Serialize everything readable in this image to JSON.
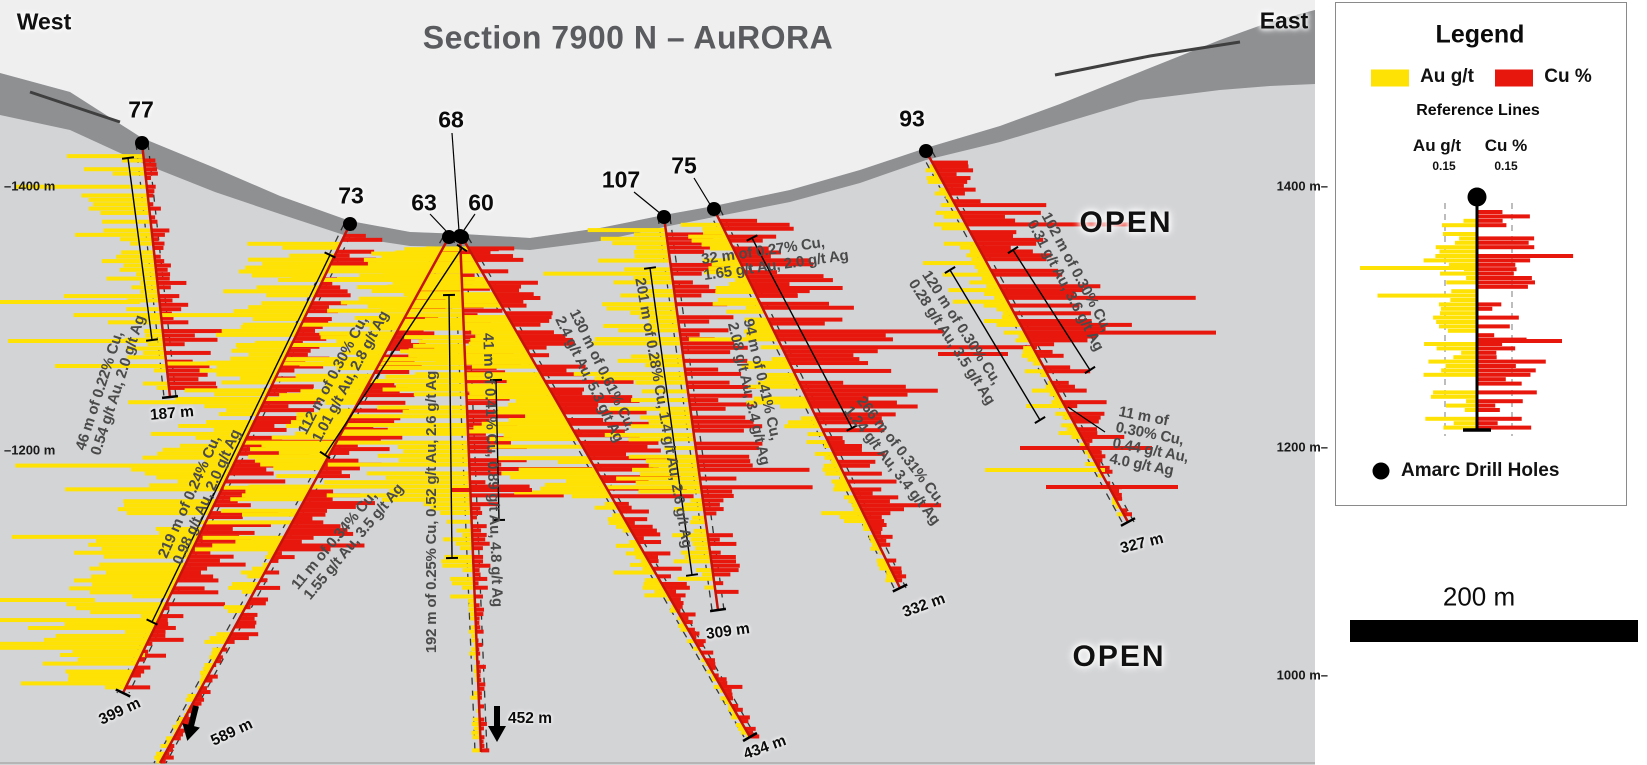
{
  "title": "Section 7900 N – AuRORA",
  "west_label": "West",
  "east_label": "East",
  "open_labels": [
    {
      "text": "OPEN",
      "x": 1126,
      "y": 223
    },
    {
      "text": "OPEN",
      "x": 1119,
      "y": 657
    }
  ],
  "elevation_labels": {
    "left": [
      {
        "text": "–1400 m",
        "y": 186
      },
      {
        "text": "–1200 m",
        "y": 450
      }
    ],
    "right": [
      {
        "text": "1400 m–",
        "y": 186
      },
      {
        "text": "1200 m–",
        "y": 447
      },
      {
        "text": "1000 m–",
        "y": 675
      }
    ]
  },
  "colors": {
    "au": "#ffe205",
    "cu": "#e8170d",
    "trace": "#c41309",
    "sky": "#efeff0",
    "body": "#d3d4d6",
    "band": "#8e9092",
    "band_dark": "#3f3f3f",
    "panel": "#ffffff",
    "annotation": "#4a4a4a",
    "frame": "#b5b5b5"
  },
  "terrain": {
    "surface": [
      [
        0,
        73
      ],
      [
        70,
        92
      ],
      [
        142,
        138
      ],
      [
        215,
        168
      ],
      [
        280,
        196
      ],
      [
        350,
        221
      ],
      [
        410,
        232
      ],
      [
        463,
        234
      ],
      [
        530,
        238
      ],
      [
        600,
        228
      ],
      [
        664,
        215
      ],
      [
        714,
        206
      ],
      [
        790,
        190
      ],
      [
        860,
        170
      ],
      [
        926,
        148
      ],
      [
        1000,
        126
      ],
      [
        1060,
        104
      ],
      [
        1140,
        72
      ],
      [
        1220,
        40
      ],
      [
        1270,
        22
      ],
      [
        1315,
        10
      ]
    ],
    "band_bottom": [
      [
        0,
        115
      ],
      [
        70,
        130
      ],
      [
        142,
        163
      ],
      [
        215,
        192
      ],
      [
        280,
        214
      ],
      [
        350,
        237
      ],
      [
        410,
        246
      ],
      [
        463,
        247
      ],
      [
        530,
        250
      ],
      [
        600,
        241
      ],
      [
        664,
        227
      ],
      [
        714,
        217
      ],
      [
        790,
        202
      ],
      [
        860,
        183
      ],
      [
        926,
        160
      ],
      [
        1000,
        142
      ],
      [
        1060,
        124
      ],
      [
        1140,
        100
      ],
      [
        1220,
        90
      ],
      [
        1270,
        86
      ],
      [
        1315,
        84
      ]
    ],
    "streaks": [
      [
        [
          1055,
          75
        ],
        [
          1150,
          56
        ],
        [
          1240,
          42
        ]
      ],
      [
        [
          30,
          92
        ],
        [
          120,
          122
        ]
      ]
    ],
    "section_width": 1315
  },
  "holes": [
    {
      "id": "77",
      "label_xy": [
        141,
        110
      ],
      "collar": [
        142,
        143
      ],
      "toe": [
        170,
        397
      ],
      "toe_tick": true,
      "depth": {
        "text": "187 m",
        "x": 172,
        "y": 414,
        "rot": -5
      },
      "profile": [
        [
          0.04,
          0.5,
          20,
          80,
          4,
          14,
          0.1
        ],
        [
          0.5,
          0.72,
          15,
          60,
          8,
          30,
          0.05
        ],
        [
          0.72,
          0.97,
          10,
          45,
          20,
          60,
          0.1
        ]
      ]
    },
    {
      "id": "73",
      "label_xy": [
        351,
        196
      ],
      "collar": [
        350,
        224
      ],
      "toe": [
        123,
        693
      ],
      "toe_tick": true,
      "depth": {
        "text": "399 m",
        "x": 120,
        "y": 712,
        "rot": -25
      },
      "profile": [
        [
          0.02,
          0.33,
          25,
          95,
          10,
          45,
          0.1
        ],
        [
          0.33,
          0.8,
          30,
          110,
          18,
          65,
          0.12
        ],
        [
          0.8,
          0.99,
          15,
          110,
          5,
          25,
          0.3
        ]
      ]
    },
    {
      "id": "63",
      "label_xy": [
        424,
        203
      ],
      "leader": [
        [
          430,
          214
        ],
        [
          448,
          233
        ]
      ],
      "collar": [
        449,
        237
      ],
      "toe": [
        160,
        763
      ],
      "toe_tick": false,
      "depth": {
        "text": "589 m",
        "x": 232,
        "y": 733,
        "rot": -25
      },
      "arrow": {
        "x": 196,
        "y": 706,
        "rot": 14
      },
      "profile": [
        [
          0.02,
          0.28,
          20,
          80,
          12,
          50,
          0.06
        ],
        [
          0.28,
          0.6,
          25,
          95,
          18,
          60,
          0.1
        ],
        [
          0.6,
          0.78,
          6,
          28,
          4,
          22,
          0.05
        ],
        [
          0.78,
          1,
          2,
          10,
          2,
          12,
          0.02
        ]
      ]
    },
    {
      "id": "68",
      "label_xy": [
        451,
        120
      ],
      "leader": [
        [
          452,
          133
        ],
        [
          459,
          231
        ]
      ],
      "collar": [
        460,
        236
      ],
      "toe": [
        481,
        752
      ],
      "toe_tick": false,
      "depth": {
        "text": "452 m",
        "x": 530,
        "y": 719,
        "rot": 0
      },
      "arrow": {
        "x": 497,
        "y": 706,
        "rot": 0
      },
      "profile": [
        [
          0.02,
          0.18,
          30,
          110,
          8,
          40,
          0.08
        ],
        [
          0.18,
          0.52,
          45,
          150,
          15,
          60,
          0.12
        ],
        [
          0.52,
          0.7,
          8,
          35,
          4,
          18,
          0.05
        ],
        [
          0.7,
          1,
          2,
          9,
          2,
          9,
          0.03
        ]
      ]
    },
    {
      "id": "60",
      "label_xy": [
        481,
        203
      ],
      "leader": [
        [
          475,
          214
        ],
        [
          462,
          233
        ]
      ],
      "collar": [
        462,
        237
      ],
      "toe": [
        750,
        737
      ],
      "toe_tick": true,
      "depth": {
        "text": "434 m",
        "x": 765,
        "y": 748,
        "rot": -20
      },
      "profile": [
        [
          0.02,
          0.28,
          40,
          130,
          15,
          55,
          0.1
        ],
        [
          0.28,
          0.52,
          30,
          100,
          30,
          90,
          0.1
        ],
        [
          0.52,
          0.72,
          6,
          24,
          8,
          30,
          0.05
        ],
        [
          0.72,
          1,
          2,
          8,
          3,
          12,
          0.02
        ]
      ]
    },
    {
      "id": "107",
      "label_xy": [
        621,
        180
      ],
      "leader": [
        [
          634,
          192
        ],
        [
          661,
          214
        ]
      ],
      "collar": [
        664,
        217
      ],
      "toe": [
        718,
        610
      ],
      "toe_tick": true,
      "depth": {
        "text": "309 m",
        "x": 728,
        "y": 632,
        "rot": -8
      },
      "profile": [
        [
          0.03,
          0.3,
          25,
          85,
          18,
          60,
          0.06
        ],
        [
          0.3,
          0.72,
          30,
          95,
          25,
          70,
          0.1
        ],
        [
          0.72,
          0.96,
          10,
          38,
          8,
          28,
          0.05
        ]
      ]
    },
    {
      "id": "75",
      "label_xy": [
        684,
        166
      ],
      "leader": [
        [
          694,
          178
        ],
        [
          711,
          206
        ]
      ],
      "collar": [
        714,
        209
      ],
      "toe": [
        900,
        588
      ],
      "toe_tick": true,
      "depth": {
        "text": "332 m",
        "x": 924,
        "y": 606,
        "rot": -20
      },
      "profile": [
        [
          0.03,
          0.25,
          10,
          45,
          30,
          90,
          0.1
        ],
        [
          0.25,
          0.58,
          15,
          55,
          40,
          115,
          0.15
        ],
        [
          0.58,
          0.83,
          6,
          28,
          15,
          55,
          0.08
        ],
        [
          0.83,
          0.99,
          3,
          12,
          5,
          20,
          0.04
        ]
      ]
    },
    {
      "id": "93",
      "label_xy": [
        912,
        119
      ],
      "collar": [
        926,
        151
      ],
      "toe": [
        1128,
        522
      ],
      "toe_tick": true,
      "depth": {
        "text": "327 m",
        "x": 1142,
        "y": 544,
        "rot": -14
      },
      "profile": [
        [
          0.03,
          0.14,
          4,
          18,
          10,
          40,
          0.05
        ],
        [
          0.14,
          0.52,
          8,
          38,
          25,
          85,
          0.12
        ],
        [
          0.52,
          0.78,
          4,
          22,
          10,
          45,
          0.08
        ],
        [
          0.78,
          0.99,
          2,
          8,
          3,
          14,
          0.03
        ]
      ]
    }
  ],
  "annotations": [
    {
      "text": "46 m of 0.22% Cu,\n0.54 g/t Au, 2.0 g/t Ag",
      "x": 111,
      "y": 383,
      "rot": -72
    },
    {
      "text": "219 m of 0.24% Cu,\n0.98 g/t Au, 2.0 g/t Ag",
      "x": 200,
      "y": 494,
      "rot": -66
    },
    {
      "text": "112 m of 0.30% Cu,\n1.01 g/t Au, 2.8 g/t Ag",
      "x": 344,
      "y": 373,
      "rot": -62
    },
    {
      "text": "11 m of 0.34% Cu,\n1.55 g/t Au, 3.5 g/t Ag",
      "x": 348,
      "y": 537,
      "rot": -50
    },
    {
      "text": "192 m of 0.25% Cu, 0.52 g/t Au, 2.6 g/t Ag",
      "x": 432,
      "y": 512,
      "rot": -90
    },
    {
      "text": "41 m of 0.41% Cu, 0.89 g/t Au, 4.8 g/t Ag",
      "x": 492,
      "y": 470,
      "rot": 88
    },
    {
      "text": "130 m of 0.61% Cu,\n2.4 g/t Au, 5.3 g/t Ag",
      "x": 596,
      "y": 376,
      "rot": 64
    },
    {
      "text": "201 m of 0.28% Cu, 1.4 g/t Au, 2.6 g/t Ag",
      "x": 663,
      "y": 413,
      "rot": 80
    },
    {
      "text": "32 m of 0.27% Cu,\n1.65 g/t Au, 2.0 g/t Ag",
      "x": 775,
      "y": 258,
      "rot": -8
    },
    {
      "text": "94 m of 0.41% Cu,\n2.08 g/t Au, 3.4 g/t Ag",
      "x": 756,
      "y": 392,
      "rot": 77
    },
    {
      "text": "266 m of 0.31% Cu,\n1.24 g/t Au, 3.4 g/t Ag",
      "x": 898,
      "y": 461,
      "rot": 52
    },
    {
      "text": "120 m of 0.30% Cu,\n0.28 g/t Au, 3.5 g/t Ag",
      "x": 958,
      "y": 338,
      "rot": 57
    },
    {
      "text": "102 m of 0.30% Cu,\n0.31 g/t Au, 3.6 g/t Ag",
      "x": 1072,
      "y": 282,
      "rot": 62
    },
    {
      "text": "11 m of\n0.30% Cu,\n0.44 g/t Au,\n4.0 g/t Ag",
      "x": 1152,
      "y": 443,
      "rot": 11
    }
  ],
  "brackets": [
    {
      "pts": [
        128,
        158,
        152,
        340
      ]
    },
    {
      "pts": [
        330,
        255,
        152,
        622
      ]
    },
    {
      "pts": [
        462,
        248,
        325,
        455
      ]
    },
    {
      "pts": [
        449,
        295,
        452,
        558
      ]
    },
    {
      "pts": [
        496,
        380,
        499,
        520
      ]
    },
    {
      "pts": [
        752,
        238,
        852,
        428
      ]
    },
    {
      "pts": [
        650,
        268,
        692,
        575
      ]
    },
    {
      "pts": [
        950,
        270,
        1040,
        420
      ]
    },
    {
      "pts": [
        1013,
        250,
        1090,
        370
      ]
    }
  ],
  "leader_lines": [
    {
      "pts": [
        1068,
        407,
        1105,
        432
      ]
    }
  ],
  "extra_bars": {
    "yellow": [
      [
        0,
        140,
        302
      ],
      [
        8,
        148,
        341
      ],
      [
        55,
        150,
        366
      ],
      [
        0,
        95,
        600
      ],
      [
        28,
        118,
        628
      ],
      [
        60,
        145,
        655
      ],
      [
        985,
        1105,
        470
      ]
    ],
    "red": [
      [
        452,
        532,
        490
      ],
      [
        938,
        1008,
        354
      ],
      [
        1020,
        1152,
        448
      ],
      [
        1046,
        1178,
        487
      ]
    ]
  },
  "legend": {
    "title": "Legend",
    "au_label": "Au g/t",
    "cu_label": "Cu %",
    "reference_title": "Reference Lines",
    "ref_au": "Au g/t",
    "ref_cu": "Cu %",
    "ref_au_value": "0.15",
    "ref_cu_value": "0.15",
    "drill_holes_label": "Amarc Drill Holes",
    "example_hole": {
      "collar": [
        1477,
        212
      ],
      "toe": [
        1477,
        430
      ],
      "profile": [
        [
          0.0,
          1.0,
          8,
          55,
          10,
          60,
          0.1
        ]
      ],
      "dashed_x": [
        1445,
        1512
      ],
      "extra_yellow": [
        [
          1360,
          1477,
          268
        ]
      ],
      "extra_red": [
        [
          1477,
          1562,
          341
        ]
      ]
    }
  },
  "scalebar": {
    "label": "200 m"
  }
}
